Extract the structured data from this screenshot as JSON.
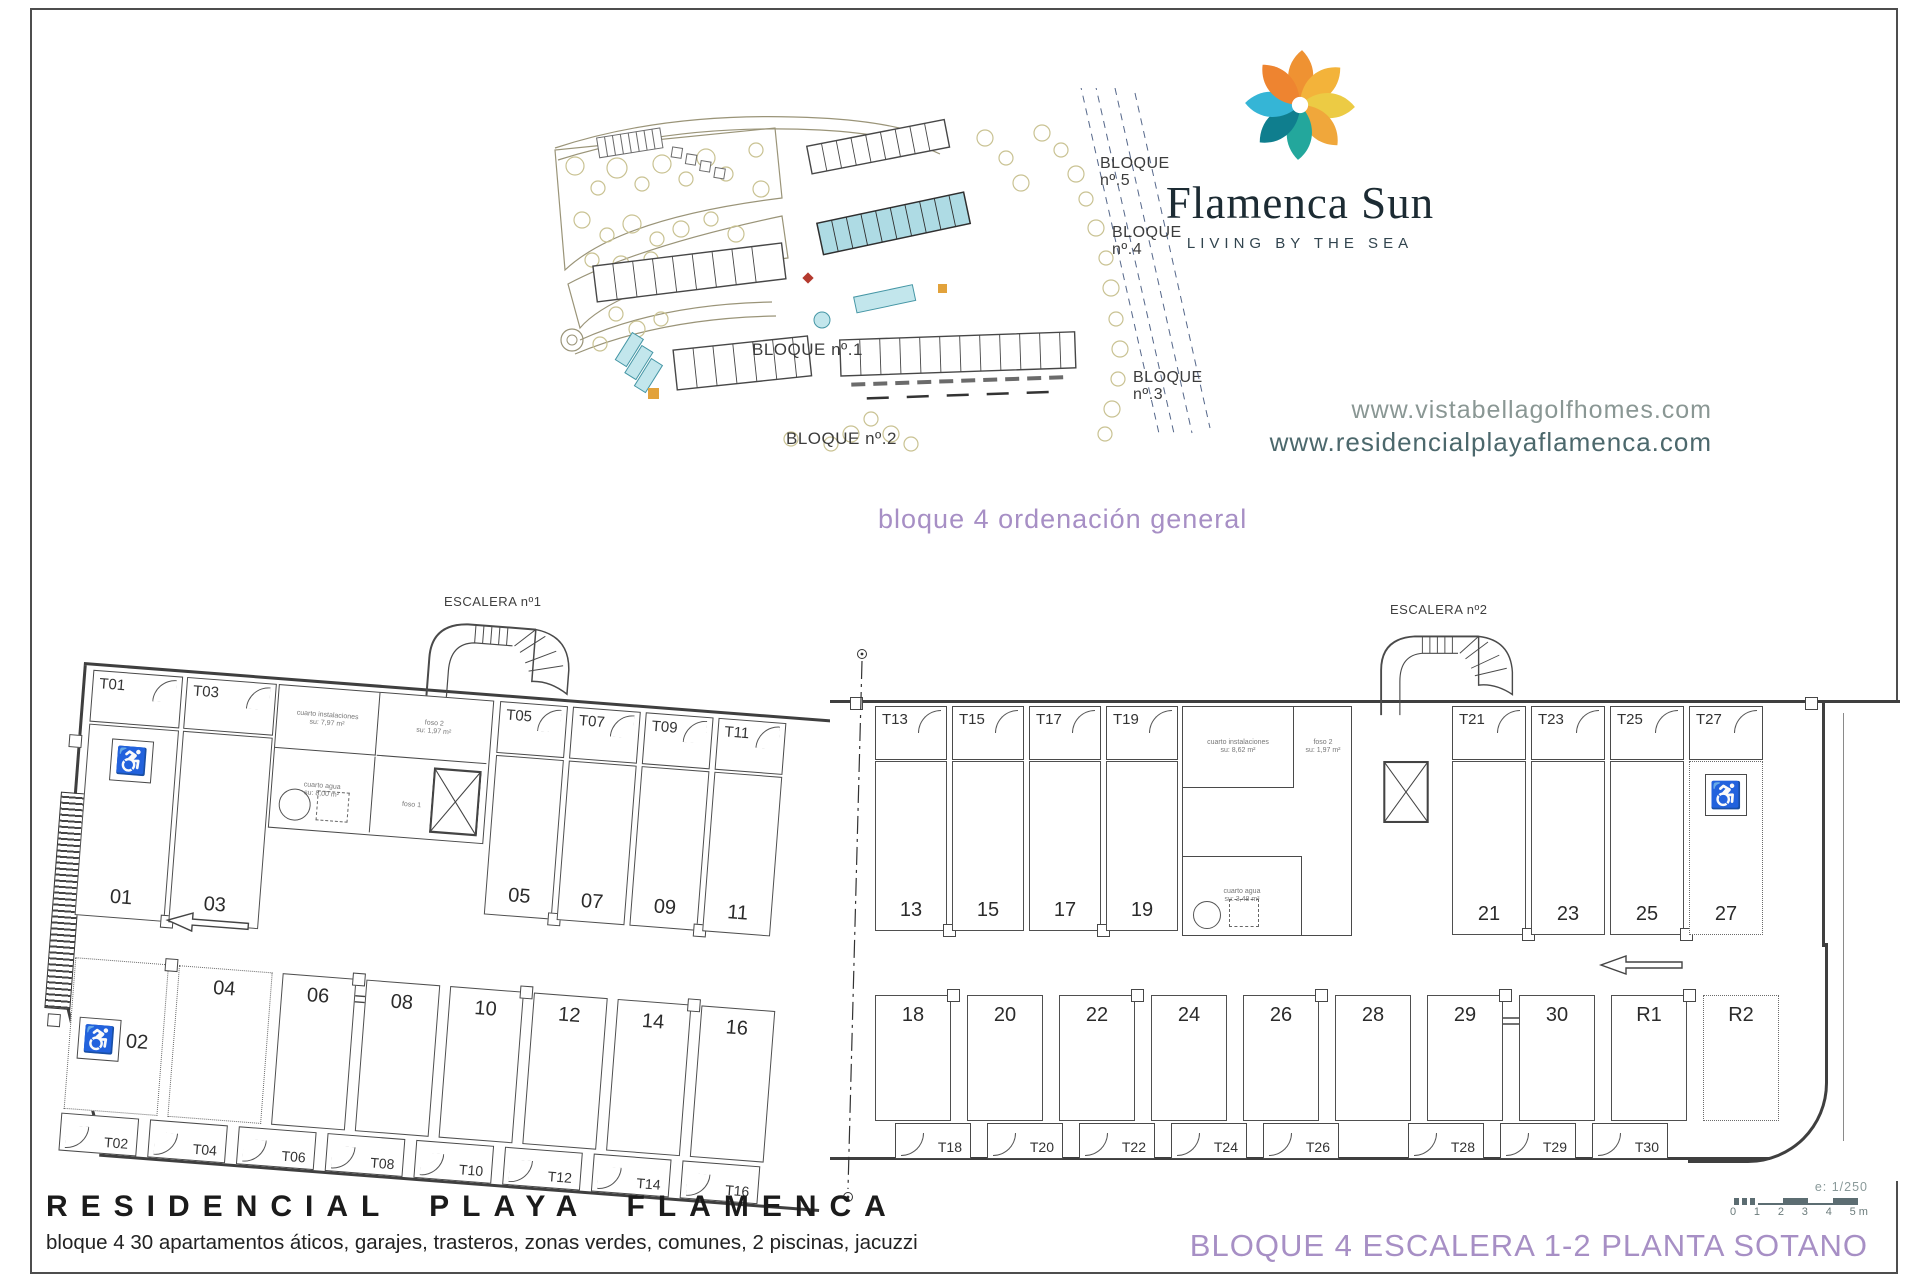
{
  "site": {
    "caption": "bloque 4 ordenación general",
    "block1": "BLOQUE nº.1",
    "block2": "BLOQUE nº.2",
    "block3_line1": "BLOQUE",
    "block3_line2": "nº.3",
    "block4_line1": "BLOQUE",
    "block4_line2": "nº.4",
    "block5_line1": "BLOQUE",
    "block5_line2": "nº.5"
  },
  "logo": {
    "brand": "Flamenca Sun",
    "tagline": "LIVING BY THE SEA"
  },
  "urls": {
    "line1": "www.vistabellagolfhomes.com",
    "line2": "www.residencialplayaflamenca.com"
  },
  "plan": {
    "escalera1": "ESCALERA nº1",
    "escalera2": "ESCALERA nº2",
    "wheelchair": "♿",
    "lw": {
      "store1": [
        {
          "label": "T01"
        },
        {
          "label": "T03"
        }
      ],
      "store2": [
        {
          "label": "T05"
        },
        {
          "label": "T07"
        },
        {
          "label": "T09"
        },
        {
          "label": "T11"
        }
      ],
      "stalls1": [
        {
          "label": "01",
          "mods": "hc"
        },
        {
          "label": "03"
        }
      ],
      "stalls2": [
        {
          "label": "05"
        },
        {
          "label": "07"
        },
        {
          "label": "09"
        },
        {
          "label": "11"
        }
      ],
      "stalls3": [
        {
          "label": "02",
          "mods": "hc dotted wide"
        },
        {
          "label": "04",
          "mods": "dotted wide"
        },
        {
          "label": "06"
        },
        {
          "label": "08"
        },
        {
          "label": "10"
        },
        {
          "label": "12"
        },
        {
          "label": "14"
        },
        {
          "label": "16"
        }
      ],
      "store3": [
        {
          "label": "T02"
        },
        {
          "label": "T04"
        },
        {
          "label": "T06"
        },
        {
          "label": "T08"
        },
        {
          "label": "T10"
        },
        {
          "label": "T12"
        },
        {
          "label": "T14"
        },
        {
          "label": "T16"
        }
      ],
      "rooms": [
        {
          "l1": "cuarto instalaciones",
          "l2": "su: 7,97 m²"
        },
        {
          "l1": "foso 2",
          "l2": "su: 1,97 m²"
        },
        {
          "l1": "cuarto agua",
          "l2": "su: 8,00 m²"
        },
        {
          "l1": "foso 1",
          "l2": "su: 8,03 m²"
        }
      ]
    },
    "rw": {
      "store1": [
        {
          "label": "T13"
        },
        {
          "label": "T15"
        },
        {
          "label": "T17"
        },
        {
          "label": "T19"
        }
      ],
      "store2": [
        {
          "label": "T21"
        },
        {
          "label": "T23"
        },
        {
          "label": "T25"
        },
        {
          "label": "T27"
        }
      ],
      "stalls1": [
        {
          "label": "13"
        },
        {
          "label": "15"
        },
        {
          "label": "17"
        },
        {
          "label": "19"
        }
      ],
      "stalls2": [
        {
          "label": "21"
        },
        {
          "label": "23"
        },
        {
          "label": "25"
        },
        {
          "label": "27",
          "mods": "hc dotted"
        }
      ],
      "stalls3": [
        {
          "label": "18"
        },
        {
          "label": "20"
        },
        {
          "label": "22"
        },
        {
          "label": "24"
        },
        {
          "label": "26"
        },
        {
          "label": "28"
        },
        {
          "label": "29"
        },
        {
          "label": "30"
        },
        {
          "label": "R1"
        },
        {
          "label": "R2",
          "mods": "dotted"
        }
      ],
      "store3": [
        {
          "label": "T18"
        },
        {
          "label": "T20"
        },
        {
          "label": "T22"
        },
        {
          "label": "T24"
        },
        {
          "label": "T26"
        }
      ],
      "store4": [
        {
          "label": "T28"
        },
        {
          "label": "T29"
        },
        {
          "label": "T30"
        }
      ],
      "rooms": [
        {
          "l1": "cuarto instalaciones",
          "l2": "su: 8,62 m²"
        },
        {
          "l1": "foso 2",
          "l2": "su: 1,97 m²"
        },
        {
          "l1": "cuarto agua",
          "l2": "su: 3,48 m²"
        }
      ]
    }
  },
  "scale": {
    "label": "e: 1/250",
    "ticks": [
      {
        "label": "0"
      },
      {
        "label": "1"
      },
      {
        "label": "2"
      },
      {
        "label": "3"
      },
      {
        "label": "4"
      },
      {
        "label": "5 m"
      }
    ]
  },
  "footer": {
    "title": "RESIDENCIAL PLAYA FLAMENCA",
    "subtitle": "bloque 4 30 apartamentos áticos, garajes, trasteros, zonas verdes, comunes, 2 piscinas, jacuzzi",
    "sheet": "BLOQUE 4 ESCALERA 1-2 PLANTA SOTANO"
  }
}
